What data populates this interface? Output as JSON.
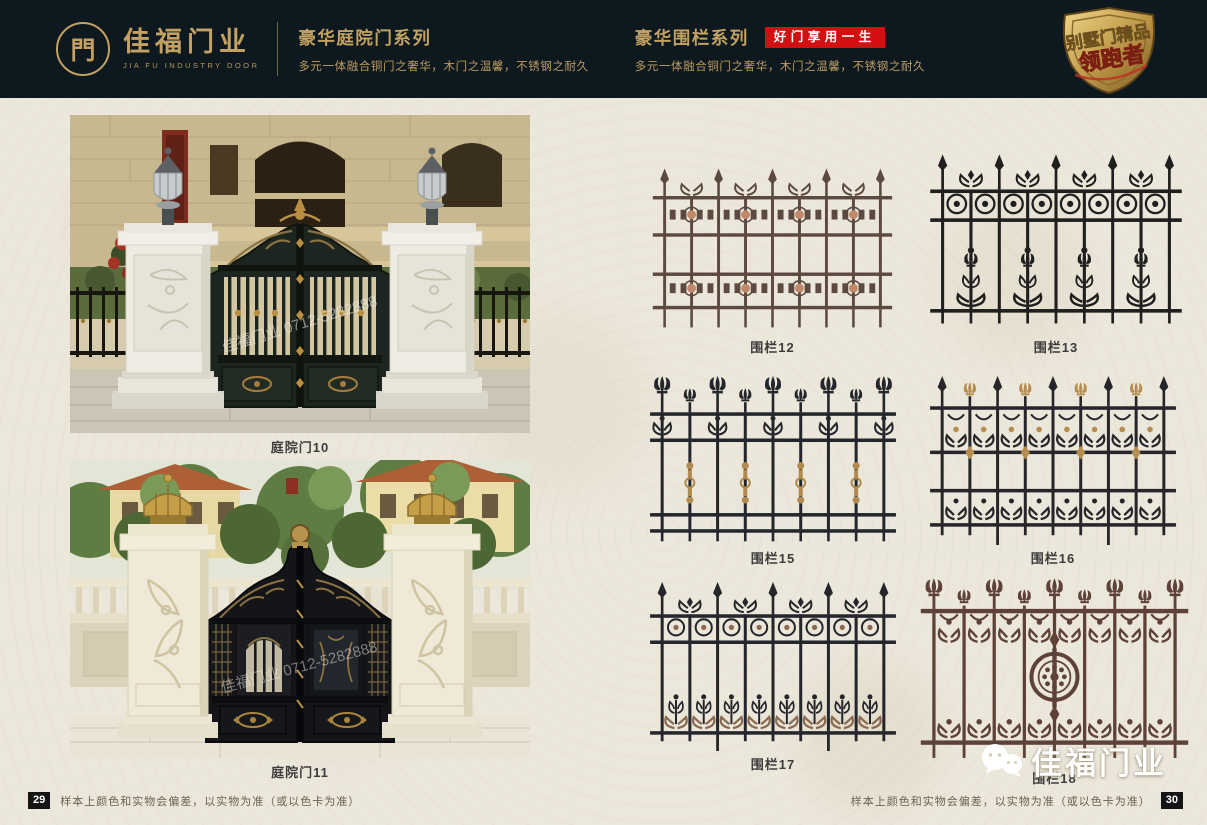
{
  "colors": {
    "header_bg": "#0d191e",
    "gold": "#c2a162",
    "badge_red": "#d21012",
    "page_bg": "#ece7db"
  },
  "header": {
    "logo": {
      "glyph": "門",
      "brand": "佳福门业",
      "brand_en": "JIA FU INDUSTRY DOOR"
    },
    "series_left": {
      "title": "豪华庭院门系列",
      "subtitle": "多元一体融合铜门之奢华，木门之温馨，不锈钢之耐久"
    },
    "series_right": {
      "title": "豪华围栏系列",
      "badge": "好门享用一生",
      "subtitle": "多元一体融合铜门之奢华，木门之温馨，不锈钢之耐久"
    },
    "emblem": {
      "line1": "别墅门精品",
      "line2": "领跑者"
    }
  },
  "gates": {
    "watermark": "佳福门业 0712-5282888",
    "items": [
      {
        "label": "庭院门10"
      },
      {
        "label": "庭院门11"
      }
    ]
  },
  "fences": {
    "items": [
      {
        "label": "围栏12",
        "style": "A",
        "body": "#5c4a40",
        "accent": "#c1886a"
      },
      {
        "label": "围栏13",
        "style": "B",
        "body": "#1f1f1f",
        "accent": "#3a3a3a"
      },
      {
        "label": "围栏15",
        "style": "C",
        "body": "#23262b",
        "accent": "#b08a4e"
      },
      {
        "label": "围栏16",
        "style": "D",
        "body": "#26262a",
        "accent": "#b68d4e"
      },
      {
        "label": "围栏17",
        "style": "E",
        "body": "#24262b",
        "accent": "#8a6a50"
      },
      {
        "label": "围栏18",
        "style": "F",
        "body": "#5e4237",
        "accent": "#8a6353"
      }
    ]
  },
  "footer": {
    "note": "样本上颜色和实物会偏差，以实物为准（或以色卡为准）",
    "page_left": "29",
    "page_right": "30",
    "watermark_brand": "佳福门业"
  }
}
